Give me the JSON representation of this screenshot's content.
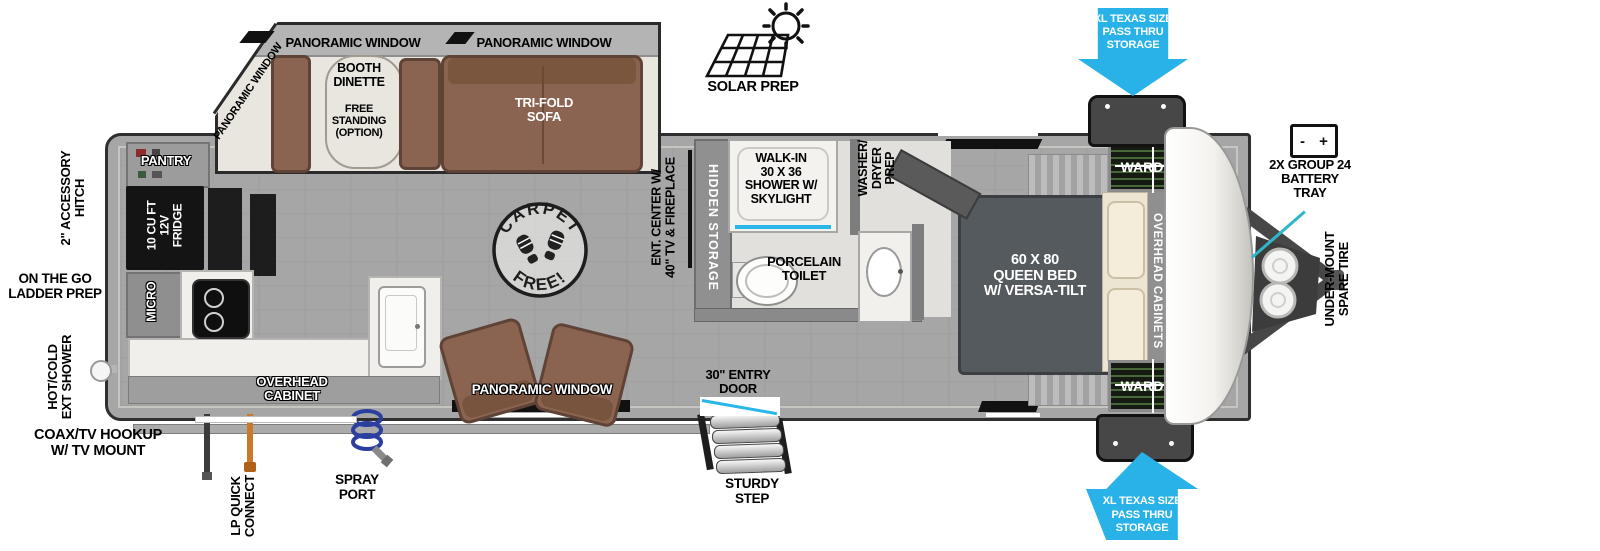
{
  "colors": {
    "arrow_blue": "#29b2e8",
    "callout_teal": "#2fb6c9",
    "shower_accent": "#29b7e8",
    "sofa_brown": "#8a6450",
    "wall_gray": "#a6a6a6",
    "lp_orange": "#c97a28",
    "spray_blue": "#2a3fa0"
  },
  "exterior": {
    "solar_prep": "SOLAR PREP",
    "pass_thru_top": "XL TEXAS SIZE\nPASS THRU\nSTORAGE",
    "pass_thru_bottom": "XL TEXAS SIZE\nPASS THRU\nSTORAGE",
    "battery_tray": "2X GROUP 24\nBATTERY\nTRAY",
    "battery_minus": "-",
    "battery_plus": "+",
    "spare_tire": "UNDER-MOUNT\nSPARE TIRE",
    "accessory_hitch": "2\" ACCESSORY\nHITCH",
    "ladder_prep": "ON THE GO\nLADDER PREP",
    "ext_shower": "HOT/COLD\nEXT SHOWER",
    "coax_hookup": "COAX/TV HOOKUP\nW/ TV MOUNT",
    "lp_connect": "LP QUICK\nCONNECT",
    "spray_port": "SPRAY\nPORT",
    "entry_door": "30\" ENTRY\nDOOR",
    "sturdy_step": "STURDY\nSTEP"
  },
  "slideout": {
    "window_left_corner": "PANORAMIC WINDOW",
    "window_top_1": "PANORAMIC WINDOW",
    "window_top_2": "PANORAMIC WINDOW",
    "dinette": "BOOTH\nDINETTE",
    "dinette_option": "FREE\nSTANDING\n(OPTION)",
    "sofa": "TRI-FOLD\nSOFA"
  },
  "kitchen": {
    "pantry": "PANTRY",
    "fridge": "10 CU FT\n12V\nFRIDGE",
    "micro": "MICRO",
    "overhead_cabinet": "OVERHEAD\nCABINET",
    "window_bottom": "PANORAMIC WINDOW"
  },
  "living": {
    "ent_center": "ENT. CENTER W/\n40\" TV & FIREPLACE",
    "hidden_storage": "HIDDEN STORAGE",
    "carpet_free_top": "CARPET",
    "carpet_free_bottom": "FREE!"
  },
  "bath": {
    "shower": "WALK-IN\n30 X 36\nSHOWER W/\nSKYLIGHT",
    "toilet": "PORCELAIN\nTOILET",
    "washer_dryer": "WASHER/\nDRYER\nPREP"
  },
  "bedroom": {
    "bed": "60 X 80\nQUEEN BED\nW/ VERSA-TILT",
    "ward_top": "WARD",
    "ward_bottom": "WARD",
    "overhead_cabinets": "OVERHEAD CABINETS"
  }
}
